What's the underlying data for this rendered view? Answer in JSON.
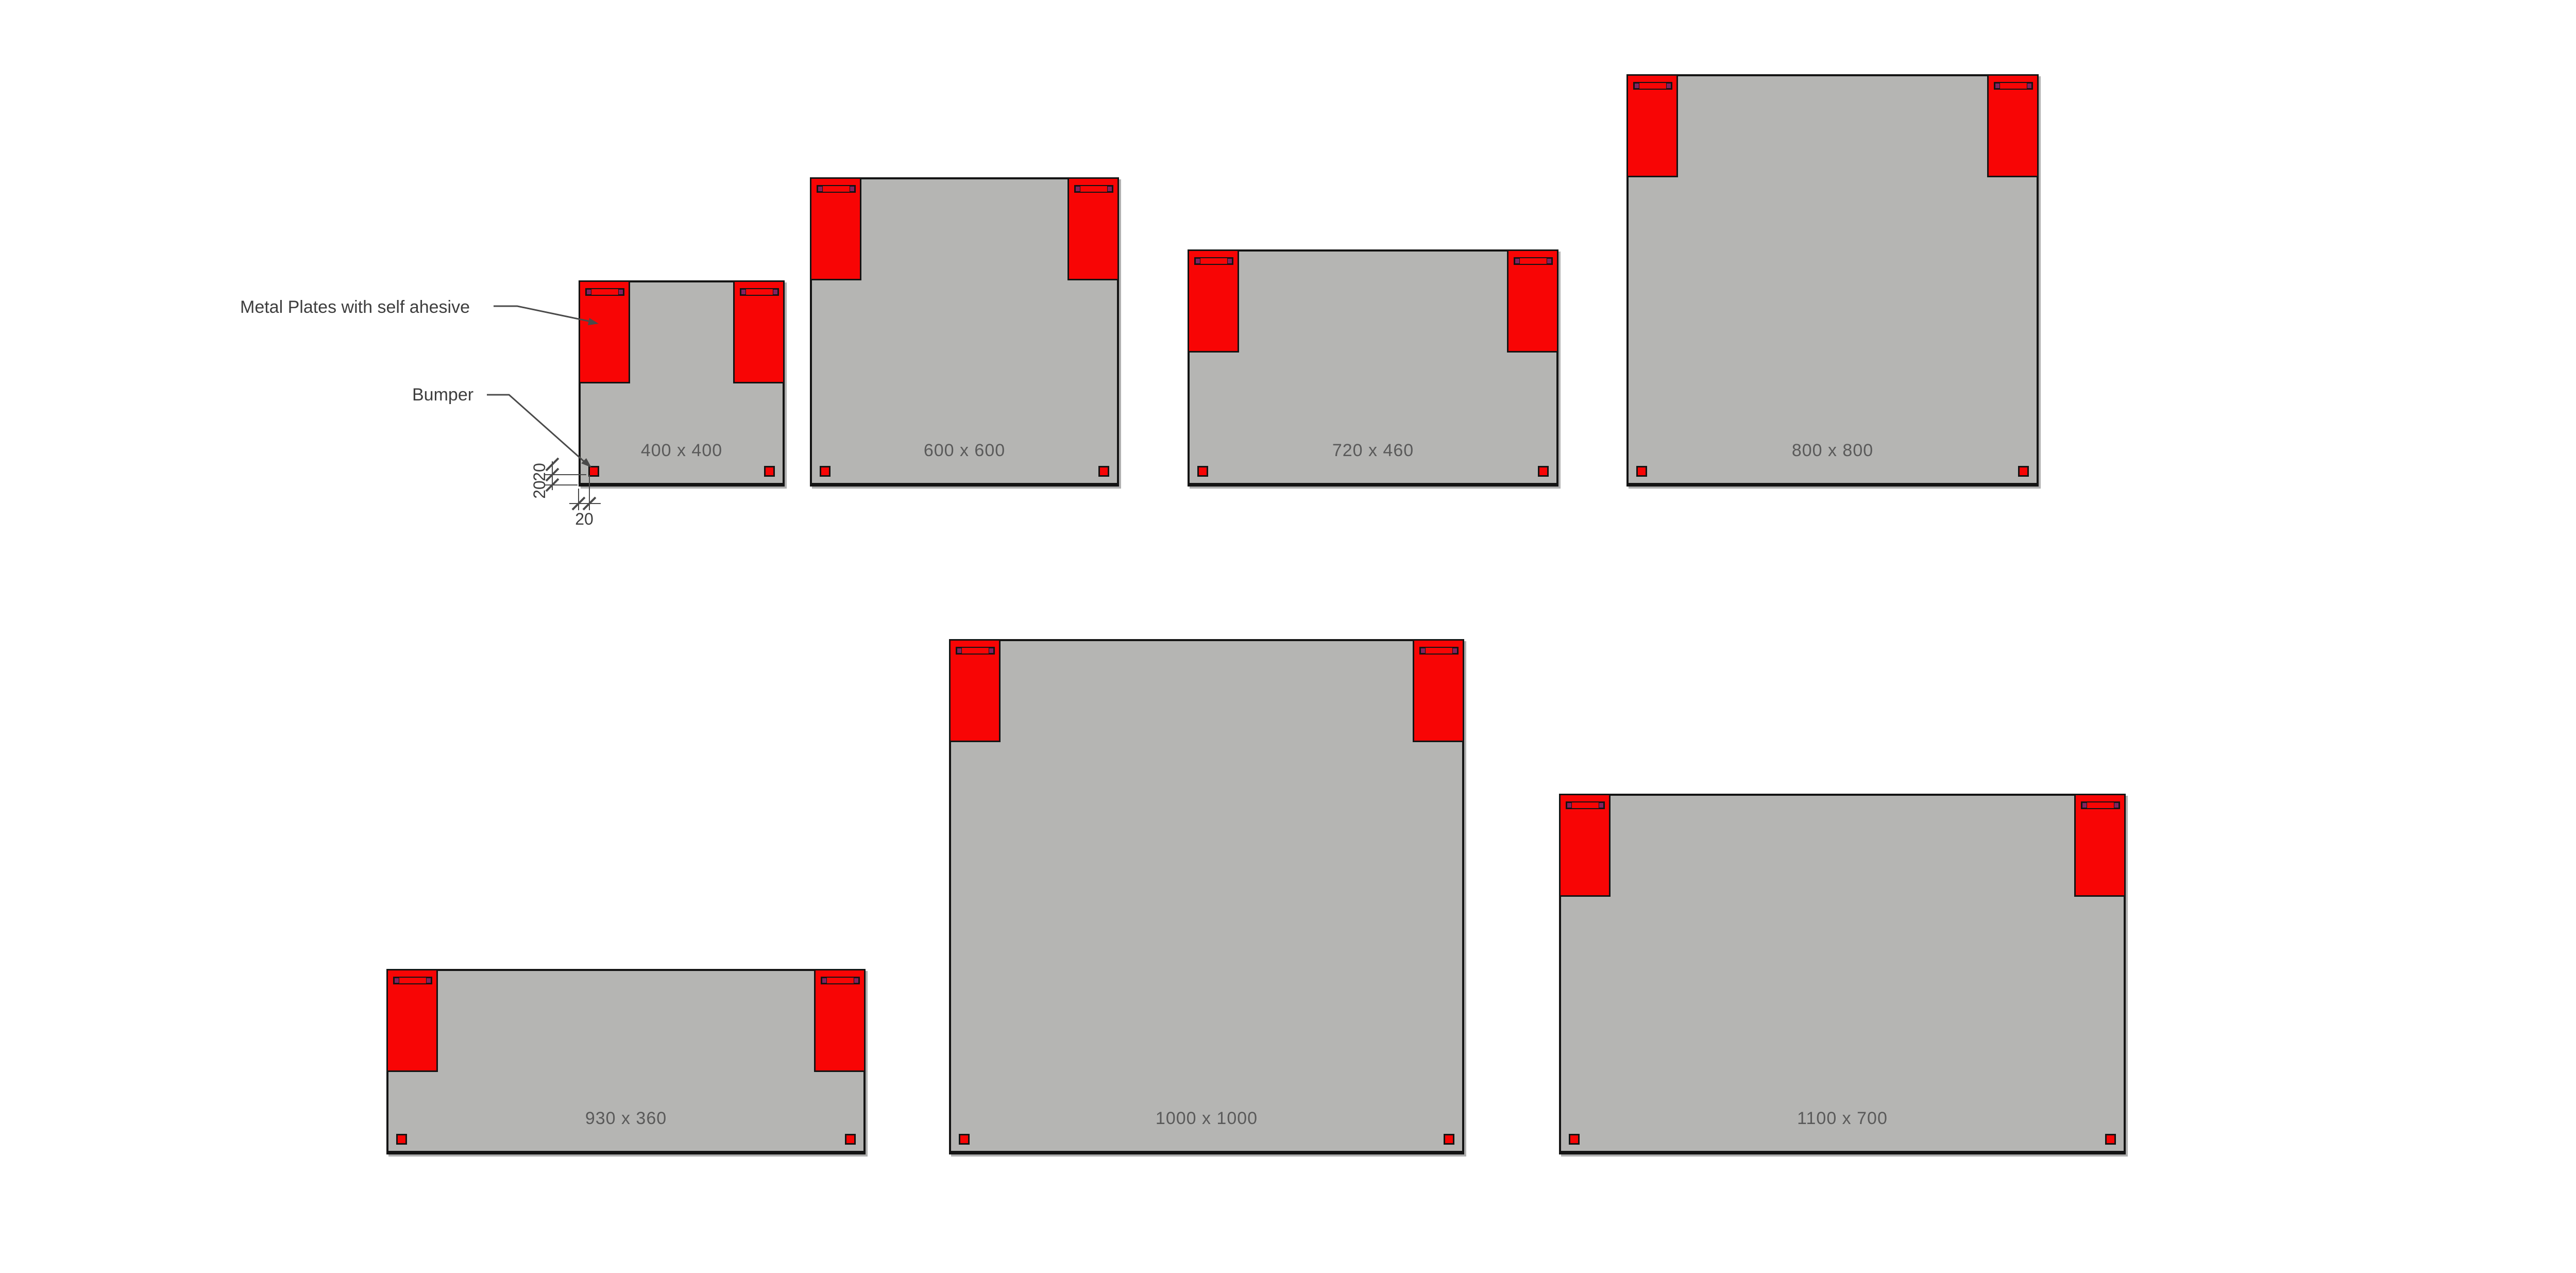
{
  "drawing": {
    "callouts": {
      "metal_plates": "Metal Plates with self ahesive",
      "bumper": "Bumper"
    },
    "dim_labels": {
      "bumper_height_mm": "20",
      "bumper_bottom_offset_mm": "20",
      "bumper_left_offset_mm": "20"
    },
    "panels": [
      {
        "label": "400 x 400",
        "width_mm": 400,
        "height_mm": 400
      },
      {
        "label": "600 x 600",
        "width_mm": 600,
        "height_mm": 600
      },
      {
        "label": "720 x 460",
        "width_mm": 720,
        "height_mm": 460
      },
      {
        "label": "800 x 800",
        "width_mm": 800,
        "height_mm": 800
      },
      {
        "label": "930 x 360",
        "width_mm": 930,
        "height_mm": 360
      },
      {
        "label": "1000 x 1000",
        "width_mm": 1000,
        "height_mm": 1000
      },
      {
        "label": "1100 x 700",
        "width_mm": 1100,
        "height_mm": 700
      }
    ],
    "colors": {
      "background": "#ffffff",
      "panel_fill": "#b5b5b3",
      "component_red": "#f80505",
      "slot_cap_purple": "#832260",
      "outline_black": "#141414",
      "panel_label_text": "#5a5a5a",
      "annotation_text": "#3e3e3e",
      "annotation_line": "#4a4a4a"
    }
  }
}
